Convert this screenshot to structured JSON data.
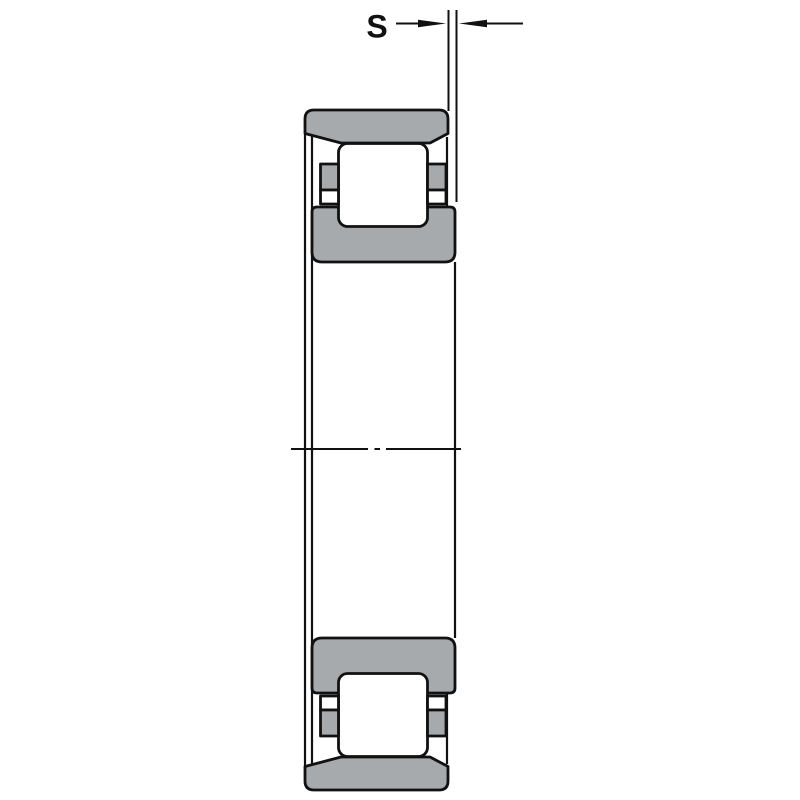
{
  "diagram": {
    "name": "cylindrical-roller-bearing-cross-section",
    "dimension_label": "S",
    "colors": {
      "section_fill": "#a7aaac",
      "line_color": "#111111",
      "background": "#ffffff"
    }
  }
}
